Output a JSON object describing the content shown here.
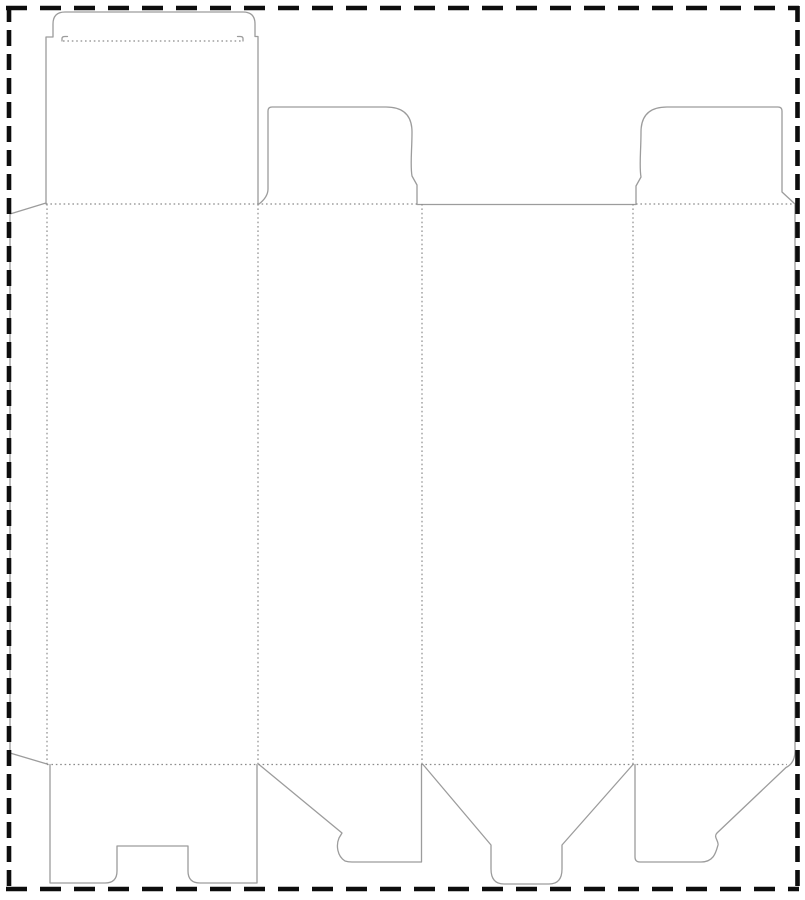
{
  "canvas": {
    "width": 805,
    "height": 900,
    "background": "#ffffff"
  },
  "styles": {
    "cut_color": "#9c9c9c",
    "cut_width": 1.3,
    "fold_color": "#8c8c8c",
    "fold_width": 1.2,
    "fold_dash": "1.6 2.8",
    "border_color": "#0d0d0d",
    "border_width": 4.6,
    "border_dash_horizontal": "21 13",
    "border_dash_vertical": "16 8"
  },
  "border_lines": [
    {
      "name": "bleed-border-top",
      "x1": 6,
      "y1": 8,
      "x2": 799,
      "y2": 8,
      "orient": "h"
    },
    {
      "name": "bleed-border-bottom",
      "x1": 6,
      "y1": 889,
      "x2": 799,
      "y2": 889,
      "orient": "h"
    },
    {
      "name": "bleed-border-left",
      "x1": 9,
      "y1": 6,
      "x2": 9,
      "y2": 893,
      "orient": "v"
    },
    {
      "name": "bleed-border-right",
      "x1": 797.5,
      "y1": 6,
      "x2": 797.5,
      "y2": 893,
      "orient": "v"
    }
  ],
  "cut_paths": [
    {
      "name": "glue-flap-outline",
      "d": "M 46,203 L 10,214 L 10,753 L 47,764"
    },
    {
      "name": "lid-panel-and-tuck-flap-outline",
      "d": "M 46,204 L 46,37 L 53,37 L 53,24 Q 53,12 65,12 L 243,12 Q 255,12 255,24 L 255,36.5 L 258,36.5 L 258,204"
    },
    {
      "name": "tuck-shoulder-hook-left",
      "d": "M 62,41 L 62,38.5 Q 62,36.5 65,36.5 L 67.5,36.5"
    },
    {
      "name": "tuck-shoulder-hook-right",
      "d": "M 243,41 L 243,38.5 Q 243,36.5 240,36.5 L 237.5,36.5"
    },
    {
      "name": "dust-flap-left-outline",
      "d": "M 259,204 Q 268,197 268,189 L 268,111 Q 268,107 272,107 L 386,107 Q 412,107 412,132 C 412,151 410,165 412,176 L 417,185 L 417,204"
    },
    {
      "name": "back-panel-top-cut-edge",
      "d": "M 417,204.5 L 636,204.5"
    },
    {
      "name": "dust-flap-right-side-panel-edge-and-bottom-flap-outline",
      "d": "M 636,204 L 636,186 L 641,177 C 639,166 641,152 641,132 Q 641,107 667,107 L 778,107 Q 782,107 782,111 L 782,192 L 795,204 L 795,751 Q 795,763 786,767.5 L 717,833 C 713,837 719,841 718,845 C 716,852 714,862 701,862 L 640,862 Q 635,862 635,857 L 635,764.5"
    },
    {
      "name": "bottom-lock-flap-front-panel-outline",
      "d": "M 50,764.5 L 50,883 L 105,883 Q 117,883 117,871 L 117,846 L 188,846 L 188,871 Q 188,883 200,883 L 257,883 L 257,764.5"
    },
    {
      "name": "bottom-flap-left-side-panel-outline",
      "d": "M 259,764.5 L 342,833 L 339,838 C 336,845 337,856 345,861 Q 348,862 352,862 L 421.5,862 L 421.5,764.5"
    },
    {
      "name": "bottom-tongue-flap-back-panel-outline",
      "d": "M 423,764.5 L 491,845 L 491,869 Q 491,884 504,884 L 549,884 Q 562,884 562,869 L 562,845 L 633,764.5"
    }
  ],
  "fold_lines": [
    {
      "name": "fold-tuck-flap",
      "x1": 63,
      "y1": 41,
      "x2": 242,
      "y2": 41
    },
    {
      "name": "fold-top-left-section",
      "x1": 46,
      "y1": 204,
      "x2": 417,
      "y2": 204
    },
    {
      "name": "fold-top-right-section",
      "x1": 636,
      "y1": 204,
      "x2": 794,
      "y2": 204
    },
    {
      "name": "fold-bottom",
      "x1": 47,
      "y1": 764.5,
      "x2": 787,
      "y2": 764.5
    },
    {
      "name": "fold-glue-flap",
      "x1": 47,
      "y1": 204,
      "x2": 47,
      "y2": 764
    },
    {
      "name": "fold-front-to-side",
      "x1": 258,
      "y1": 204,
      "x2": 258,
      "y2": 764
    },
    {
      "name": "fold-side-to-back",
      "x1": 422,
      "y1": 204,
      "x2": 422,
      "y2": 764
    },
    {
      "name": "fold-back-to-side",
      "x1": 633,
      "y1": 204,
      "x2": 633,
      "y2": 764
    }
  ]
}
